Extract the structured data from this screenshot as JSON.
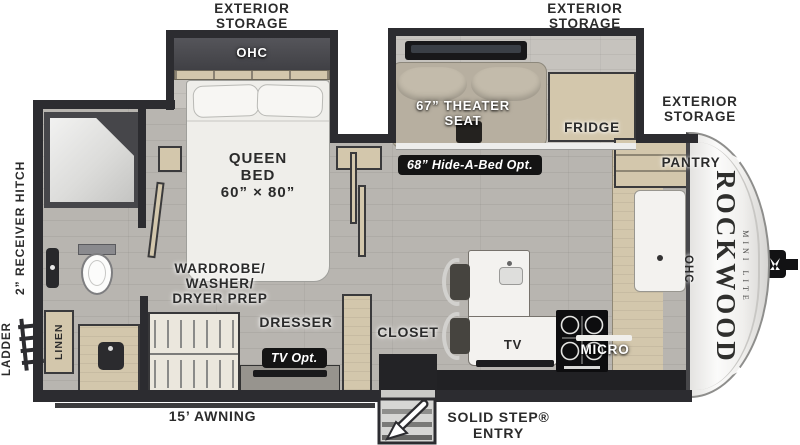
{
  "title": "Rockwood Mini Lite travel trailer floor plan",
  "brand": {
    "name": "ROCKWOOD",
    "trim": "MINI LITE"
  },
  "exterior": {
    "storage_bedroom": [
      "EXTERIOR",
      "STORAGE"
    ],
    "storage_living": [
      "EXTERIOR",
      "STORAGE"
    ],
    "storage_front": [
      "EXTERIOR",
      "STORAGE"
    ],
    "ladder": "LADDER",
    "receiver_hitch": "2” RECEIVER HITCH",
    "awning": "15’ AWNING",
    "solid_step": [
      "SOLID STEP®",
      "ENTRY"
    ]
  },
  "bedroom": {
    "ohc": "OHC",
    "bed": [
      "QUEEN",
      "BED",
      "60” × 80”"
    ],
    "wardrobe": [
      "WARDROBE/",
      "WASHER/",
      "DRYER PREP"
    ],
    "dresser": "DRESSER",
    "tv_opt": "TV Opt.",
    "closet": "CLOSET"
  },
  "living": {
    "theater_seat": [
      "67” THEATER",
      "SEAT"
    ],
    "hide_a_bed": "68” Hide-A-Bed Opt.",
    "fridge": "FRIDGE",
    "tv": "TV"
  },
  "kitchen": {
    "pantry": "PANTRY",
    "micro": "MICRO",
    "ohc": "OHC"
  },
  "bath": {
    "linen": "LINEN"
  },
  "colors": {
    "wall": "#2c2c30",
    "floor": "#b8b5b0",
    "slide_floor": "#c6c3be",
    "cabinet": "#d3c7ac",
    "seat": "#b7afa0",
    "counter_dark": "#212124",
    "badge_bg": "#141414",
    "badge_text": "#ffffff",
    "label": "#2b2b2b",
    "appliance_white": "#f3f2ef"
  }
}
